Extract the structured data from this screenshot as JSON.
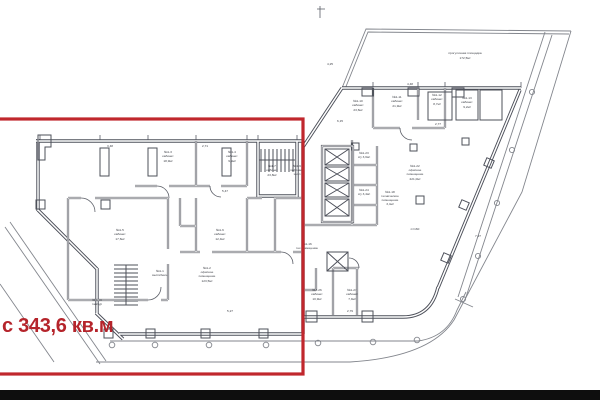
{
  "overlay": {
    "label": "с 343,6 кв.м"
  },
  "colors": {
    "accent": "#c0272d",
    "label_red": "#b5242b",
    "line": "#4d505a",
    "bar": "#0e0e0e"
  },
  "plan": {
    "labels": [
      {
        "x": 168,
        "y": 153,
        "t": "№1-3"
      },
      {
        "x": 168,
        "y": 157,
        "t": "кабинет"
      },
      {
        "x": 168,
        "y": 162,
        "t": "18,9м²"
      },
      {
        "x": 232,
        "y": 153,
        "t": "№1-4"
      },
      {
        "x": 232,
        "y": 157,
        "t": "кабинет"
      },
      {
        "x": 232,
        "y": 162,
        "t": "9,9м²"
      },
      {
        "x": 272,
        "y": 167,
        "t": "№1-7"
      },
      {
        "x": 272,
        "y": 171,
        "t": "кабинет"
      },
      {
        "x": 272,
        "y": 176,
        "t": "23,8м²"
      },
      {
        "x": 120,
        "y": 231,
        "t": "№1-5"
      },
      {
        "x": 120,
        "y": 235,
        "t": "кабинет"
      },
      {
        "x": 120,
        "y": 240,
        "t": "17,6м²"
      },
      {
        "x": 220,
        "y": 231,
        "t": "№1-6"
      },
      {
        "x": 220,
        "y": 235,
        "t": "кабинет"
      },
      {
        "x": 220,
        "y": 240,
        "t": "12,4м²"
      },
      {
        "x": 207,
        "y": 269,
        "t": "№1-2"
      },
      {
        "x": 207,
        "y": 273,
        "t": "офисное"
      },
      {
        "x": 207,
        "y": 277,
        "t": "помещение"
      },
      {
        "x": 207,
        "y": 282,
        "t": "123,5м²"
      },
      {
        "x": 97,
        "y": 301,
        "t": "№1-19"
      },
      {
        "x": 97,
        "y": 305,
        "t": "тамбур"
      },
      {
        "x": 160,
        "y": 272,
        "t": "№1-1"
      },
      {
        "x": 160,
        "y": 276,
        "t": "вестибюль"
      },
      {
        "x": 297,
        "y": 167,
        "t": "№1-9"
      },
      {
        "x": 297,
        "y": 171,
        "t": "лифтовой"
      },
      {
        "x": 297,
        "y": 175,
        "t": "холл"
      },
      {
        "x": 364,
        "y": 154,
        "t": "№1-23"
      },
      {
        "x": 364,
        "y": 158,
        "t": "с/у 3,6м²"
      },
      {
        "x": 364,
        "y": 191,
        "t": "№1-24"
      },
      {
        "x": 364,
        "y": 195,
        "t": "с/у 3,4м²"
      },
      {
        "x": 358,
        "y": 102,
        "t": "№1-10"
      },
      {
        "x": 358,
        "y": 106,
        "t": "кабинет"
      },
      {
        "x": 358,
        "y": 111,
        "t": "23,6м²"
      },
      {
        "x": 397,
        "y": 98,
        "t": "№1-11"
      },
      {
        "x": 397,
        "y": 102,
        "t": "кабинет"
      },
      {
        "x": 397,
        "y": 107,
        "t": "21,9м²"
      },
      {
        "x": 437,
        "y": 96,
        "t": "№1-12"
      },
      {
        "x": 437,
        "y": 100,
        "t": "кабинет"
      },
      {
        "x": 437,
        "y": 105,
        "t": "8,7м²"
      },
      {
        "x": 467,
        "y": 99,
        "t": "№1-13"
      },
      {
        "x": 467,
        "y": 103,
        "t": "кабинет"
      },
      {
        "x": 467,
        "y": 108,
        "t": "9,2м²"
      },
      {
        "x": 415,
        "y": 167,
        "t": "№1-22"
      },
      {
        "x": 415,
        "y": 171,
        "t": "офисное"
      },
      {
        "x": 415,
        "y": 175,
        "t": "помещение"
      },
      {
        "x": 415,
        "y": 180,
        "t": "221,0м²"
      },
      {
        "x": 390,
        "y": 193,
        "t": "№1-18"
      },
      {
        "x": 390,
        "y": 197,
        "t": "техническое"
      },
      {
        "x": 390,
        "y": 201,
        "t": "помещение"
      },
      {
        "x": 390,
        "y": 205,
        "t": "3,4м²"
      },
      {
        "x": 307,
        "y": 245,
        "t": "№1-16"
      },
      {
        "x": 307,
        "y": 249,
        "t": "тех.помещение"
      },
      {
        "x": 317,
        "y": 291,
        "t": "№1-26"
      },
      {
        "x": 317,
        "y": 295,
        "t": "кабинет"
      },
      {
        "x": 317,
        "y": 300,
        "t": "10,9м²"
      },
      {
        "x": 352,
        "y": 291,
        "t": "№1-27"
      },
      {
        "x": 352,
        "y": 295,
        "t": "кабинет"
      },
      {
        "x": 352,
        "y": 300,
        "t": "7,9м²"
      },
      {
        "x": 465,
        "y": 54,
        "t": "прогулочная площадка",
        "n": "terrace-label"
      },
      {
        "x": 465,
        "y": 59,
        "t": "172,5м²",
        "n": "terrace-label"
      },
      {
        "x": 415,
        "y": 230,
        "t": "п=160"
      },
      {
        "x": 110,
        "y": 147,
        "t": "3,48",
        "n": "dimension-label"
      },
      {
        "x": 205,
        "y": 147,
        "t": "2,71",
        "n": "dimension-label"
      },
      {
        "x": 410,
        "y": 85,
        "t": "4,48",
        "n": "dimension-label"
      },
      {
        "x": 340,
        "y": 122,
        "t": "6,15",
        "n": "dimension-label"
      },
      {
        "x": 225,
        "y": 192,
        "t": "5,47",
        "n": "dimension-label"
      },
      {
        "x": 438,
        "y": 125,
        "t": "2,77",
        "n": "dimension-label"
      },
      {
        "x": 230,
        "y": 312,
        "t": "5,27",
        "n": "dimension-label"
      },
      {
        "x": 350,
        "y": 312,
        "t": "2,79",
        "n": "dimension-label"
      },
      {
        "x": 330,
        "y": 65,
        "t": "4,25",
        "n": "dimension-label"
      },
      {
        "x": 478,
        "y": 237,
        "t": "7,27",
        "n": "dimension-label"
      }
    ]
  }
}
